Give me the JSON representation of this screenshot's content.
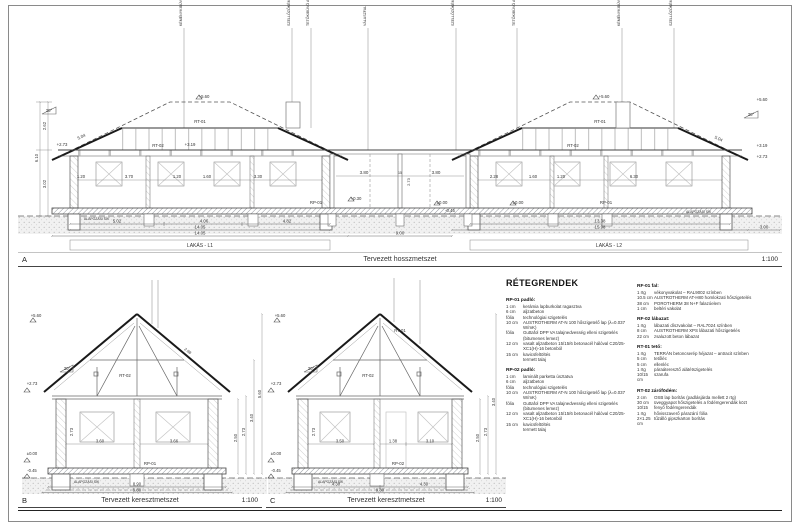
{
  "sections": {
    "a": {
      "letter": "A",
      "title": "Tervezett hosszmetszet",
      "scale": "1:100"
    },
    "b": {
      "letter": "B",
      "title": "Tervezett keresztmetszet",
      "scale": "1:100"
    },
    "c": {
      "letter": "C",
      "title": "Tervezett keresztmetszet",
      "scale": "1:100"
    }
  },
  "a": {
    "lakas_l1": "LAKÁS - L1",
    "lakas_l2": "LAKÁS - L2",
    "alap_sik_l": "ALAPOZÁSI SÍK",
    "alap_sik_r": "ALAPOZÁSI SÍK",
    "rt01_l": "RT-01",
    "rt01_r": "RT-01",
    "rt02_l": "RT-02",
    "rt02_r": "RT-02",
    "rp01_l": "RP-01",
    "rp01_r": "RP-01",
    "deg_l": "30°",
    "deg_r": "30°",
    "slope_l": "5.04",
    "slope_r": "5.04",
    "lv_ridge_l": "+5.60",
    "lv_ridge_r": "+5.60",
    "lv_319_l": "+3.19",
    "lv_273_l": "+2.73",
    "lv_000_m": "±0.00",
    "lv_000_r": "±0.00",
    "lv_030": "+0.30",
    "lv_045": "-0.45",
    "lv_r1": "+5.60",
    "lv_r2": "+3.19",
    "lv_r3": "+2.73",
    "dims_l1": [
      "5.02",
      "4.06",
      "4.82"
    ],
    "tot_l1_a": "14.05",
    "tot_l1_b": "14.05",
    "mid_dim": "9.00",
    "mid_dims": [
      "3.80",
      "15",
      "3.80"
    ],
    "mid_h": "2.73",
    "dims_l2": [
      "13.38"
    ],
    "tot_l2": "15.98",
    "terrace": "3.00",
    "int_l1": [
      "1.20",
      "3.70",
      "1.20",
      "1.60",
      "3.30"
    ],
    "int_l2": [
      "2.28",
      "1.60",
      "1.20",
      "6.30"
    ],
    "vchain": [
      "2.62",
      "3.02",
      "6.10"
    ],
    "annotations": [
      "KÉMÉNYKIBÚVÓ",
      "SZELLŐZŐKÉMÉNY",
      "TETŐKIBÚVÓ ABLAK",
      "VÁLASZFAL",
      "SZELLŐZŐKÉMÉNY",
      "TETŐKIBÚVÓ ABLAK",
      "KÉMÉNYKIBÚVÓ",
      "SZELLŐZŐKÉMÉNY"
    ]
  },
  "b": {
    "rt02": "RT-02",
    "rp01": "RP-01",
    "deg": "30°",
    "slope_len": "2.98",
    "lv_top": "+5.60",
    "lv_273": "+2.73",
    "lv_000": "±0.00",
    "lv_045": "-0.45",
    "rooms": [
      "3.60",
      "3.66"
    ],
    "h": "2.73",
    "rchain": [
      "2.50",
      "2.73",
      "3.40",
      "5.60"
    ],
    "alap": "ALAPOZÁSI SÍK",
    "bot": "8.90",
    "bot_total": "9.80"
  },
  "c": {
    "rt01": "RT-01",
    "rt02": "RT-02",
    "rp02": "RP-02",
    "deg": "30°",
    "lv_top": "+5.60",
    "lv_273": "+2.73",
    "lv_000": "±0.00",
    "lv_045": "-0.45",
    "rooms": [
      "3.50",
      "1.38",
      "3.10"
    ],
    "h": "2.73",
    "rchain": [
      "2.50",
      "2.73",
      "3.40"
    ],
    "alap": "ALAPOZÁSI SÍK",
    "bot1": "4.30",
    "bot2": "4.30",
    "bot_total": "9.80"
  },
  "legend": {
    "title": "RÉTEGRENDEK",
    "col1": [
      {
        "title": "RP-01 padló:",
        "rows": [
          [
            "1 cm",
            "kerámia lapburkolat ragasztva"
          ],
          [
            "6 cm",
            "aljzatbeton"
          ],
          [
            "fólia",
            "technológiai szigetelés"
          ],
          [
            "10 cm",
            "AUSTROTHERM AT-N 100 hőszigetelő lap (λ=0.037 W/mK)"
          ],
          [
            "fólia",
            "Guttafol DPP VA talajnedvesség elleni szigetelés (bitumenes lemez)"
          ],
          [
            "12 cm",
            "vasalt aljzatbeton 15/15/6 betonacél hálóval C20/25-XC1(H)-16 betonból"
          ],
          [
            "15 cm",
            "kavicsfeltöltés"
          ],
          [
            "",
            "termett talaj"
          ]
        ]
      },
      {
        "title": "RP-02 padló:",
        "rows": [
          [
            "1 cm",
            "laminált parketta úsztatva"
          ],
          [
            "6 cm",
            "aljzatbeton"
          ],
          [
            "fólia",
            "technológiai szigetelés"
          ],
          [
            "10 cm",
            "AUSTROTHERM AT-N 100 hőszigetelő lap (λ=0.037 W/mK)"
          ],
          [
            "fólia",
            "Guttafol DPP VA talajnedvesség elleni szigetelés (bitumenes lemez)"
          ],
          [
            "12 cm",
            "vasalt aljzatbeton 15/15/6 betonacél hálóval C20/25-XC1(H)-16 betonból"
          ],
          [
            "15 cm",
            "kavicsfeltöltés"
          ],
          [
            "",
            "termett talaj"
          ]
        ]
      }
    ],
    "col2": [
      {
        "title": "RF-01 fal:",
        "rows": [
          [
            "1 rtg",
            "vékonyvakolat – RAL9002 színben"
          ],
          [
            "10.5 cm",
            "AUSTROTHERM AT-H80 homlokzati hőszigetelés"
          ],
          [
            "38 cm",
            "POROTHERM 38 N+F falazóelem"
          ],
          [
            "1 cm",
            "beltéri vakolat"
          ]
        ]
      },
      {
        "title": "RF-02 lábazat:",
        "rows": [
          [
            "1 rtg",
            "lábazati díszvakolat – RAL7024 színben"
          ],
          [
            "8 cm",
            "AUSTROTHERM XPS lábazati hőszigetelés"
          ],
          [
            "22 cm",
            "zsaluzott beton lábazat"
          ]
        ]
      },
      {
        "title": "RT-01 tető:",
        "rows": [
          [
            "1 rtg",
            "TERRÁN betoncserép héjazat – antracit színben"
          ],
          [
            "5 cm",
            "tetőléc"
          ],
          [
            "5 cm",
            "ellenléc"
          ],
          [
            "1 rtg",
            "páraáteresztő alátétszigetelés"
          ],
          [
            "10/15 cm",
            "szarufa"
          ]
        ]
      },
      {
        "title": "RT-02 zárófödém:",
        "rows": [
          [
            "2 cm",
            "OSB lap borítás (padlásjárda mellett 2 rtg)"
          ],
          [
            "30 cm",
            "üveggyapot hőszigetelés a födémgerendák közt"
          ],
          [
            "10/15",
            "fenyő födémgerendák"
          ],
          [
            "1 rtg",
            "hővisszaverő párazáró fólia"
          ],
          [
            "2×1.25 cm",
            "tűzálló gipszkarton borítás"
          ]
        ]
      }
    ]
  }
}
